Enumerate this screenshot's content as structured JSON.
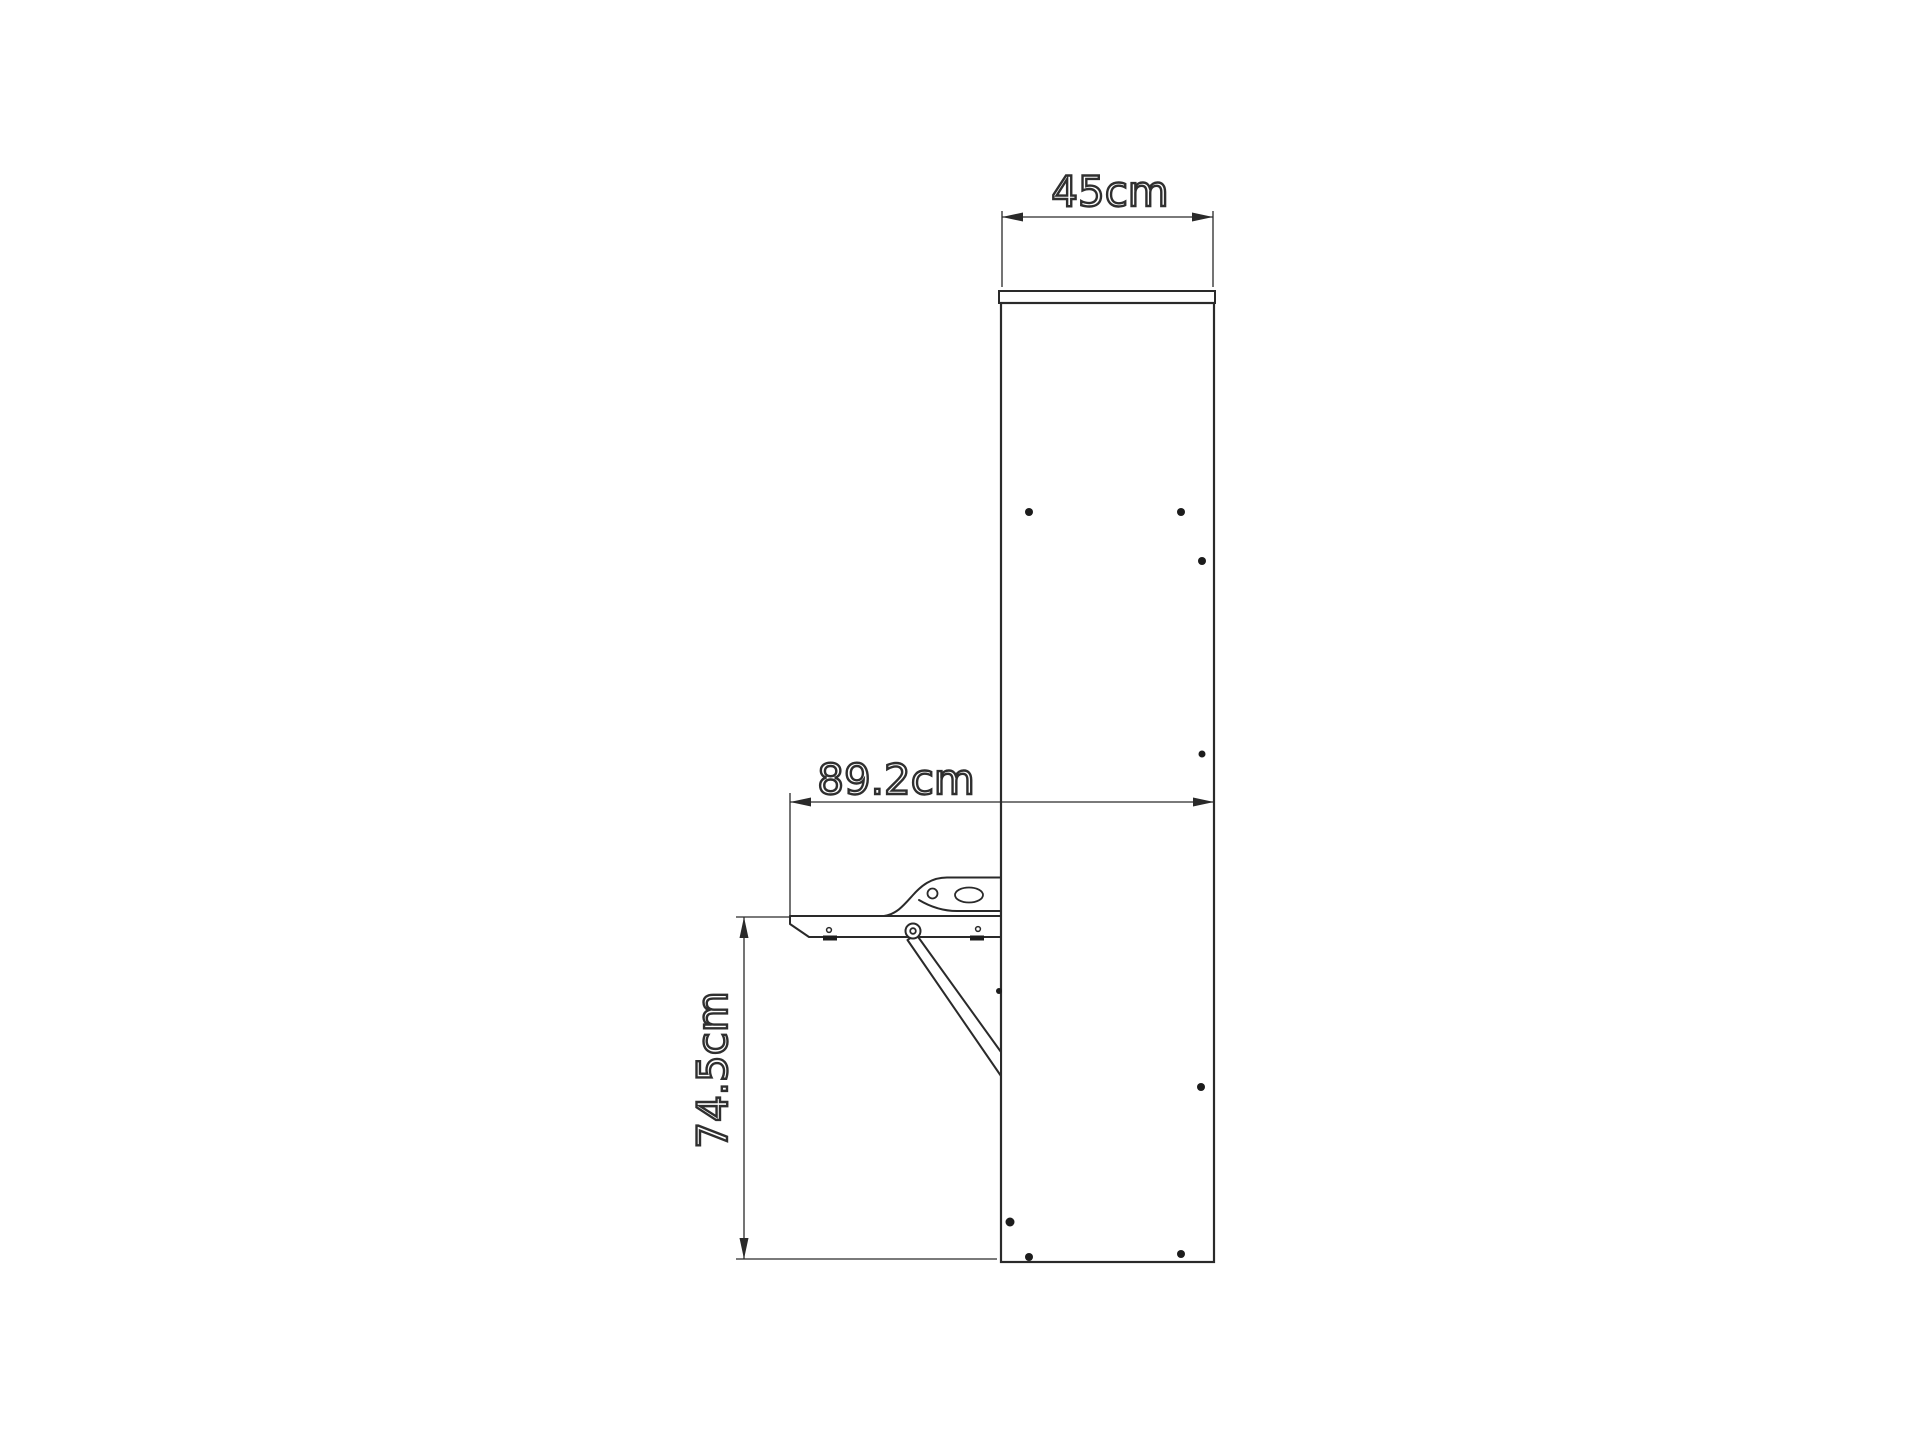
{
  "page": {
    "background_color": "#ffffff"
  },
  "drawing": {
    "description": "Side-view technical drawing of a wall-mounted cabinet with fold-down table leaf, support strut and mounting holes",
    "line_color": "#2a2a2a",
    "dot_color": "#1c1c1c",
    "label_style": {
      "fill_color": "#ffffff",
      "outline_color": "#2f2f2f"
    },
    "dimensions": {
      "cabinet_depth": {
        "label": "45cm",
        "orientation": "horizontal"
      },
      "table_reach": {
        "label": "89.2cm",
        "orientation": "horizontal"
      },
      "table_height": {
        "label": "74.5cm",
        "orientation": "vertical"
      }
    }
  }
}
